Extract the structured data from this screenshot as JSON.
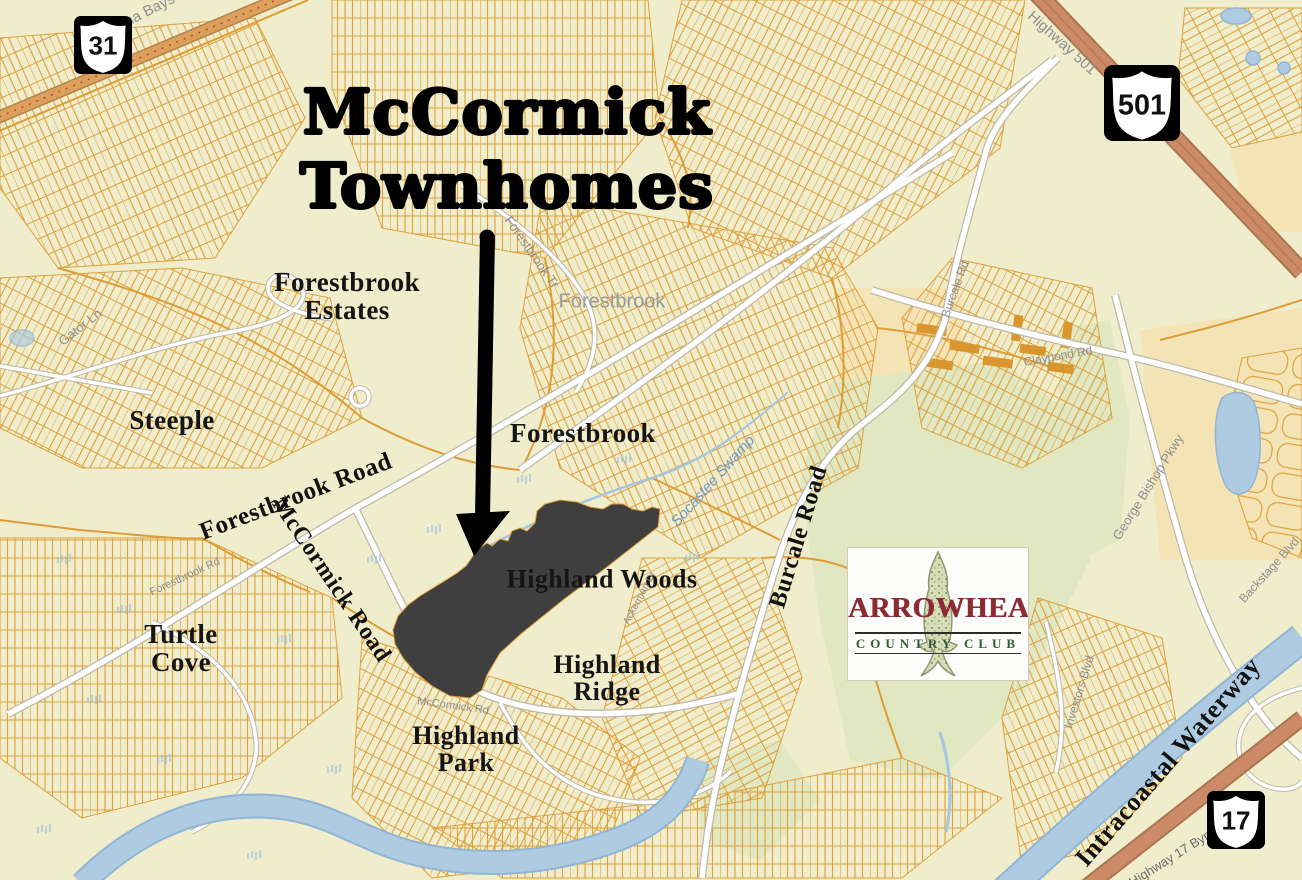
{
  "map": {
    "title": {
      "text": "McCormick\nTownhomes"
    },
    "shields": [
      {
        "id": "route-31",
        "number": "31"
      },
      {
        "id": "route-501",
        "number": "501"
      },
      {
        "id": "route-17",
        "number": "17"
      }
    ],
    "neighborhoods": [
      {
        "id": "forestbrook-estates",
        "text": "Forestbrook\nEstates"
      },
      {
        "id": "steeple",
        "text": "Steeple"
      },
      {
        "id": "forestbrook",
        "text": "Forestbrook"
      },
      {
        "id": "turtle-cove",
        "text": "Turtle\nCove"
      },
      {
        "id": "highland-woods",
        "text": "Highland Woods"
      },
      {
        "id": "highland-ridge",
        "text": "Highland\nRidge"
      },
      {
        "id": "highland-park",
        "text": "Highland\nPark"
      }
    ],
    "road_labels": [
      {
        "id": "forestbrook-road",
        "text": "Forestbrook Road"
      },
      {
        "id": "mccormick-road",
        "text": "McCormick Road"
      },
      {
        "id": "burcale-road",
        "text": "Burcale Road"
      },
      {
        "id": "intracoastal-waterway",
        "text": "Intracoastal Waterway"
      }
    ],
    "street_labels": [
      {
        "id": "carolina-bays-pkwy",
        "text": "Carolina Bays Pkwy"
      },
      {
        "id": "highway-501",
        "text": "Highway 501"
      },
      {
        "id": "burcale-rd-small",
        "text": "Burcale Rd"
      },
      {
        "id": "claypond-rd",
        "text": "Claypond Rd"
      },
      {
        "id": "forestbrook-tr",
        "text": "Forestbrook Tr"
      },
      {
        "id": "forestbrook-gray",
        "text": "Forestbrook"
      },
      {
        "id": "gator-ln",
        "text": "Gator Ln"
      },
      {
        "id": "forestbrook-rd-small",
        "text": "Forestbrook Rd"
      },
      {
        "id": "mccormick-rd-small",
        "text": "McCormick Rd"
      },
      {
        "id": "ackerman-dr",
        "text": "Ackerman Dr"
      },
      {
        "id": "george-bishop-pkwy",
        "text": "George Bishop Pkwy"
      },
      {
        "id": "backstage-blvd",
        "text": "Backstage Blvd"
      },
      {
        "id": "investors-blvd",
        "text": "Investors Blvd"
      },
      {
        "id": "highway-17-byp",
        "text": "Highway 17 Byp"
      }
    ],
    "water_labels": [
      {
        "id": "socastee-swamp",
        "text": "Socastee Swamp"
      }
    ],
    "logo": {
      "title": "ARROWHEAD",
      "subtitle": "COUNTRY CLUB"
    },
    "colors": {
      "background": "#f0edcc",
      "streets": "#dd9d36",
      "water": "#aecbe2",
      "highway": "#cd8a68",
      "golf": "#dfe7c0",
      "site": "#3f3f3f",
      "label_gray": "#8e8e8e",
      "label_blue": "#6f98c5",
      "logo_red": "#8c2b33",
      "logo_green": "#2f5b36"
    }
  }
}
